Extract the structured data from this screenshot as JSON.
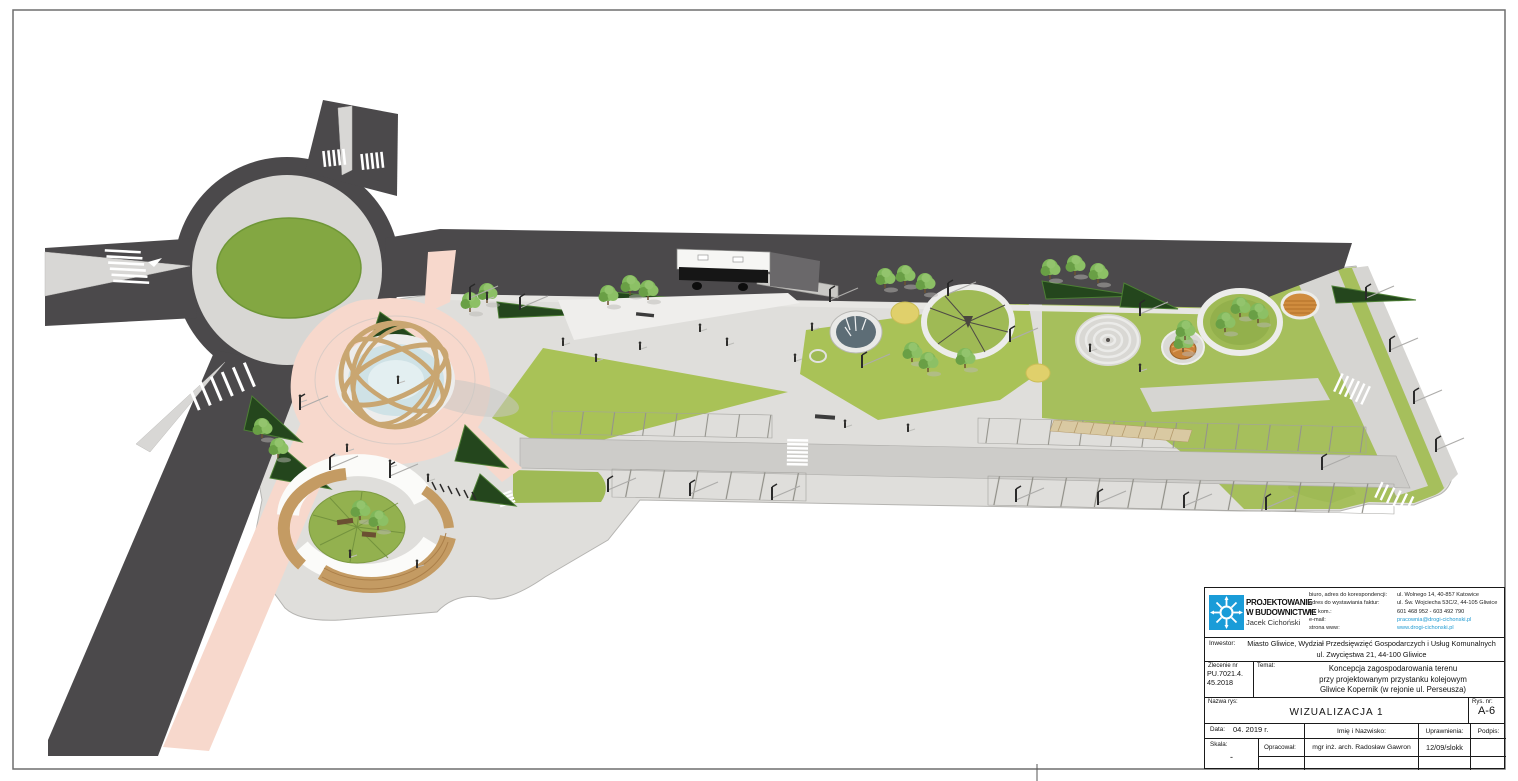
{
  "sheet": {
    "background": "#ffffff",
    "border_color": "#6e6e6e"
  },
  "title_block": {
    "company": {
      "line1": "PROJEKTOWANIE",
      "line2": "W BUDOWNICTWIE",
      "line3": "Jacek Cichoński",
      "logo_color": "#1a9cd8"
    },
    "contact": {
      "link_color": "#1f9ad2",
      "rows": [
        {
          "label": "biuro, adres do korespondencji:",
          "value": "ul. Wolnego 14, 40-857 Katowice"
        },
        {
          "label": "adres do wystawiania faktur:",
          "value": "ul. Św. Wojciecha 53C/2, 44-105 Gliwice"
        },
        {
          "label": "tel. kom.:",
          "value": "601 468 952 - 603 492 790"
        },
        {
          "label": "e-mail:",
          "value": "pracownia@drogi-cichonski.pl"
        },
        {
          "label": "strona www:",
          "value": "www.drogi-cichonski.pl"
        }
      ]
    },
    "inwestor_label": "Inwestor:",
    "inwestor_line1": "Miasto Gliwice, Wydział Przedsięwzięć Gospodarczych i Usług Komunalnych",
    "inwestor_line2": "ul. Zwycięstwa 21, 44-100 Gliwice",
    "zlecenie_label": "Zlecenie nr",
    "zlecenie_line1": "PU.7021.4.",
    "zlecenie_line2": "45.2018",
    "temat_label": "Temat:",
    "temat_line1": "Koncepcja zagospodarowania terenu",
    "temat_line2": "przy projektowanym przystanku kolejowym",
    "temat_line3": "Gliwice Kopernik (w rejonie ul. Perseusza)",
    "nazwa_label": "Nazwa rys:",
    "nazwa_value": "WIZUALIZACJA 1",
    "rys_label": "Rys. nr:",
    "rys_value": "A-6",
    "data_label": "Data:",
    "data_value": "04. 2019 r.",
    "imie_label": "Imię i Nazwisko:",
    "uprawnienia_label": "Uprawnienia:",
    "podpis_label": "Podpis:",
    "skala_label": "Skala:",
    "skala_value": "-",
    "opracowal_label": "Opracował:",
    "opracowal_name": "mgr inż. arch. Radosław Gawron",
    "opracowal_uprawnienia": "12/09/slokk"
  },
  "scene": {
    "type": "3d-site-plan-visualization",
    "palette": {
      "road": "#4b494b",
      "concrete": "#dfdedb",
      "aisle": "#cdccc9",
      "sidewalk": "#d6d5d2",
      "lawn": "#a6bf5c",
      "roundabout_island": "#83a742",
      "hedge": "#24461d",
      "bike_path": "#f7d8cc",
      "pool_water": "#cfe2e6",
      "fountain_water": "#5d6d76",
      "wood": "#c49b63",
      "yellow_play": "#e0d06b",
      "orange_deck": "#d08c3e",
      "marking": "#ffffff"
    },
    "features": [
      "roundabout-with-green-island",
      "zebra-crossings",
      "street-network",
      "bike-path-pink",
      "armillary-sphere-fountain",
      "circular-wooden-benches",
      "green-mound-with-trees",
      "bus-on-street",
      "bus-platform",
      "hedge-wedges",
      "lawn-triangles",
      "water-fountain-circle",
      "play-ring",
      "concentric-mound",
      "basket-swing-circle",
      "tree-ring",
      "orange-deck-circle",
      "yellow-play-circles",
      "parking-rows-with-stalls",
      "street-lamps",
      "pedestrians",
      "bike-racks"
    ]
  }
}
